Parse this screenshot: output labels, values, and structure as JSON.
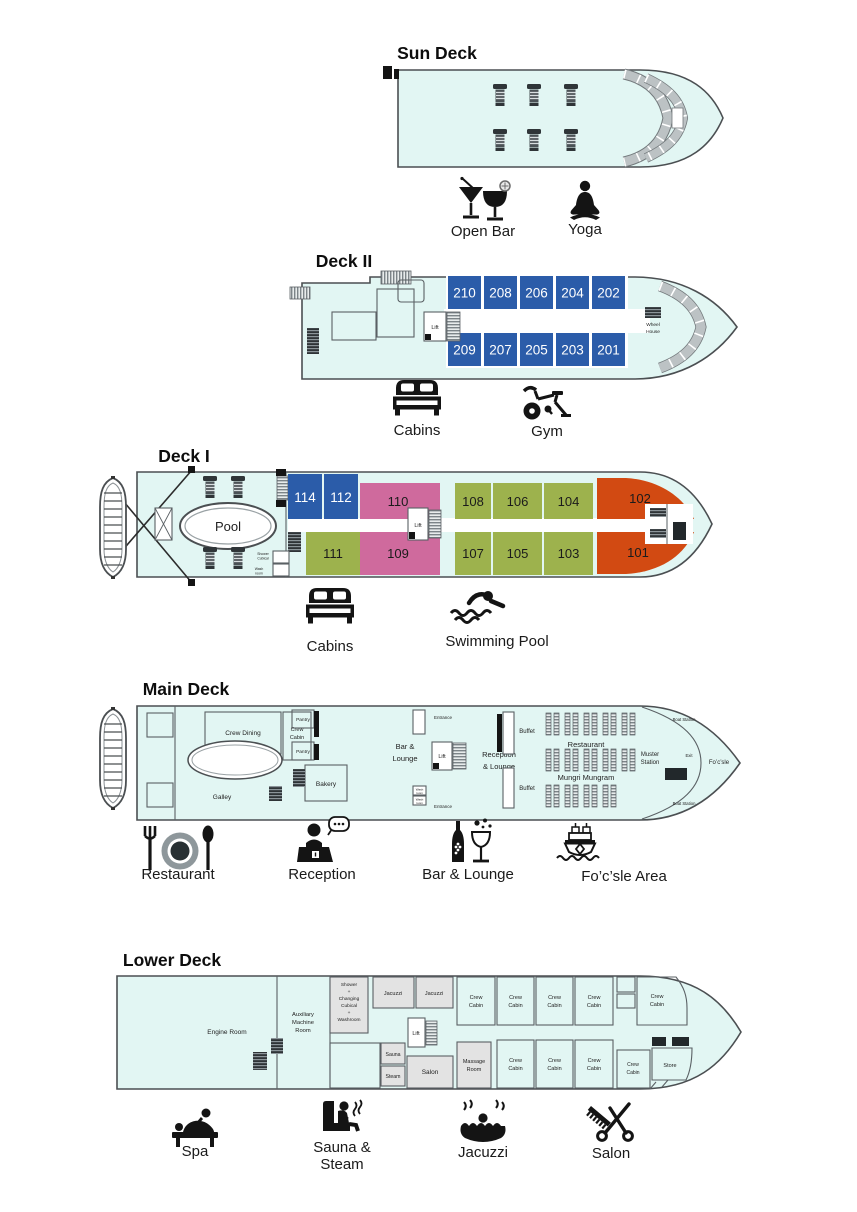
{
  "colors": {
    "hull": "#e2f6f3",
    "outline": "#4b4f52",
    "cabin_blue": "#2b5ca9",
    "cabin_green": "#9db24d",
    "cabin_pink": "#cf6a9d",
    "cabin_orange": "#d24a12",
    "room_gray": "#e3e3e3",
    "band_gray": "#bcc2c4"
  },
  "sun_deck": {
    "title": "Sun Deck",
    "amenities": {
      "open_bar": "Open Bar",
      "yoga": "Yoga"
    }
  },
  "deck2": {
    "title": "Deck II",
    "lift": "Lift",
    "wheel_house": [
      "Wheel",
      "House"
    ],
    "cabins_top": [
      "210",
      "208",
      "206",
      "204",
      "202"
    ],
    "cabins_bottom": [
      "209",
      "207",
      "205",
      "203",
      "201"
    ],
    "amenities": {
      "cabins": "Cabins",
      "gym": "Gym"
    }
  },
  "deck1": {
    "title": "Deck I",
    "pool": "Pool",
    "lift": "Lift",
    "shower_cubical": [
      "Shower",
      "Cubical"
    ],
    "wash_room": [
      "Wash",
      "room"
    ],
    "cabins_top": [
      "114",
      "112",
      "110",
      "108",
      "106",
      "104",
      "102"
    ],
    "cabins_bottom": [
      "111",
      "109",
      "107",
      "105",
      "103",
      "101"
    ],
    "amenities": {
      "cabins": "Cabins",
      "swimming_pool": "Swimming Pool"
    }
  },
  "main_deck": {
    "title": "Main Deck",
    "rooms": {
      "crew_dining": "Crew Dining",
      "crew_cabin": [
        "Crew",
        "Cabin"
      ],
      "pantry": "Pantry",
      "galley": "Galley",
      "bakery": "Bakery",
      "bar_lounge": [
        "Bar &",
        "Lounge"
      ],
      "lift": "Lift",
      "reception": [
        "Reception",
        "& Lounge"
      ],
      "entrance": "Entrance",
      "wash_room": [
        "Wash",
        "room"
      ],
      "buffet": "Buffet",
      "restaurant": "Restaurant",
      "restaurant_name": "Mungri Mungram",
      "muster": [
        "Muster",
        "Station"
      ],
      "exit": "Exit",
      "focsle": "Fo’c’sle",
      "boat_station": "Boat Station"
    },
    "amenities": {
      "restaurant": "Restaurant",
      "reception": "Reception",
      "bar_lounge": "Bar & Lounge",
      "focsle_area": "Fo’c’sle Area"
    }
  },
  "lower_deck": {
    "title": "Lower Deck",
    "rooms": {
      "engine": "Engine Room",
      "aux": [
        "Auxiliary",
        "Machine",
        "Room"
      ],
      "shower": [
        "Shower",
        "+",
        "Changing",
        "Cubical",
        "+",
        "Washroom"
      ],
      "jacuzzi": "Jacuzzi",
      "lift": "Lift",
      "sauna": "Sauna",
      "steam": "Steam",
      "salon": "Salon",
      "massage": [
        "Massage",
        "Room"
      ],
      "crew_cabin": [
        "Crew",
        "Cabin"
      ],
      "store": "Store"
    },
    "amenities": {
      "spa": "Spa",
      "sauna_steam": [
        "Sauna &",
        "Steam"
      ],
      "jacuzzi": "Jacuzzi",
      "salon": "Salon"
    }
  }
}
